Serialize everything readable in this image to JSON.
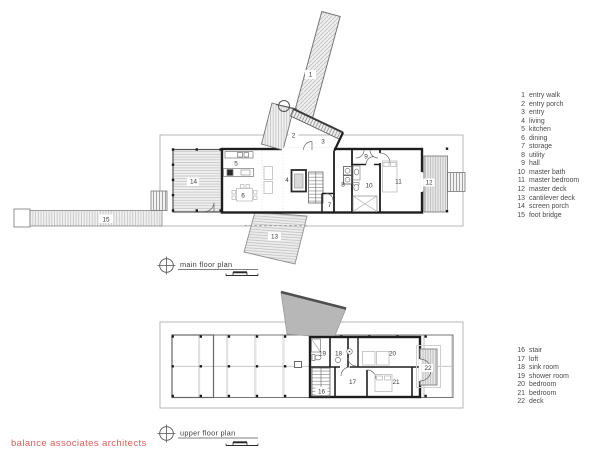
{
  "brand": {
    "name": "balance associates architects"
  },
  "colors": {
    "brand_red": "#dd5f5c",
    "plan_line": "#1e1e1e",
    "hatch": "#c0c0c0",
    "roof_gray": "#b7b7b7"
  },
  "titles": {
    "main": "main floor plan",
    "upper": "upper floor plan"
  },
  "legend_main": [
    {
      "num": "1",
      "label": "entry walk"
    },
    {
      "num": "2",
      "label": "entry porch"
    },
    {
      "num": "3",
      "label": "entry"
    },
    {
      "num": "4",
      "label": "living"
    },
    {
      "num": "5",
      "label": "kitchen"
    },
    {
      "num": "6",
      "label": "dining"
    },
    {
      "num": "7",
      "label": "storage"
    },
    {
      "num": "8",
      "label": "utility"
    },
    {
      "num": "9",
      "label": "hall"
    },
    {
      "num": "10",
      "label": "master bath"
    },
    {
      "num": "11",
      "label": "master bedroom"
    },
    {
      "num": "12",
      "label": "master deck"
    },
    {
      "num": "13",
      "label": "cantilever deck"
    },
    {
      "num": "14",
      "label": "screen porch"
    },
    {
      "num": "15",
      "label": "foot bridge"
    }
  ],
  "legend_upper": [
    {
      "num": "16",
      "label": "stair"
    },
    {
      "num": "17",
      "label": "loft"
    },
    {
      "num": "18",
      "label": "sink room"
    },
    {
      "num": "19",
      "label": "shower room"
    },
    {
      "num": "20",
      "label": "bedroom"
    },
    {
      "num": "21",
      "label": "bedroom"
    },
    {
      "num": "22",
      "label": "deck"
    }
  ],
  "room_numbers": {
    "main": [
      "1",
      "2",
      "3",
      "4",
      "5",
      "6",
      "7",
      "8",
      "9",
      "10",
      "11",
      "12",
      "13",
      "14",
      "15"
    ],
    "upper": [
      "16",
      "17",
      "18",
      "19",
      "20",
      "21",
      "22"
    ]
  }
}
